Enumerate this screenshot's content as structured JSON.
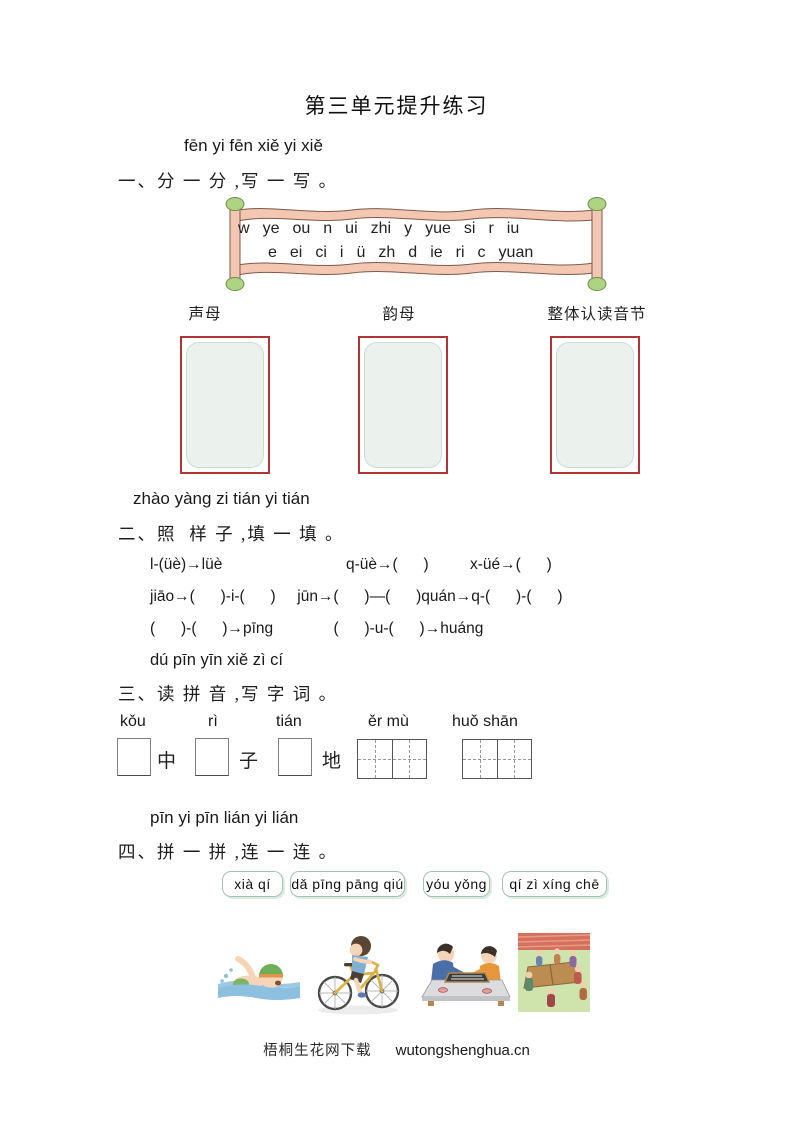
{
  "page": {
    "title": "第三单元提升练习",
    "footer": {
      "site_name": "梧桐生花网下载",
      "site_url": "wutongshenghua.cn"
    }
  },
  "section1": {
    "pinyin_intro": "fēn yi fēn xiě yi xiě",
    "heading": "一、分 一 分 ,写 一 写 。",
    "scroll": {
      "row1": [
        "w",
        "ye",
        "ou",
        "n",
        "ui",
        "zhi",
        "y",
        "yue",
        "si",
        "r",
        "iu"
      ],
      "row2": [
        "e",
        "ei",
        "ci",
        "i",
        "ü",
        "zh",
        "d",
        "ie",
        "ri",
        "c",
        "yuan"
      ]
    },
    "categories": [
      "声母",
      "韵母",
      "整体认读音节"
    ]
  },
  "section2": {
    "pinyin_intro": "zhào yàng zi tián yi tián",
    "heading": "二、照  样 子 ,填 一 填 。",
    "row1": [
      "l-(üè)→lüè",
      "q-üè→(      )",
      "x-üé→(      )"
    ],
    "row2": "jiāo→(      )-i-(      )     jūn→(      )—(      )quán→q-(      )-(      )",
    "row3": "(      )-(      )→pīng              (      )-u-(      )→huáng"
  },
  "section3": {
    "pinyin_intro": "dú pīn yīn xiě zì cí",
    "heading": "三、读 拼 音 ,写 字 词 。",
    "items": [
      {
        "pinyin": "kǒu",
        "character": "中",
        "box": "single"
      },
      {
        "pinyin": "rì",
        "character": "子",
        "box": "single"
      },
      {
        "pinyin": "tián",
        "character": "地",
        "box": "single"
      },
      {
        "pinyin": "ěr mù",
        "box": "double-grid"
      },
      {
        "pinyin": "huǒ shān",
        "box": "double-grid"
      }
    ]
  },
  "section4": {
    "pinyin_intro": "pīn yi pīn lián yi lián",
    "heading": "四、拼 一 拼 ,连 一 连 。",
    "tags": [
      "xià qí",
      "dǎ pīng pāng qiú",
      "yóu yǒng",
      "qí zì xíng chē"
    ],
    "images": [
      "swimming",
      "riding-bicycle",
      "playing-board-game",
      "playing-table-tennis"
    ]
  },
  "colors": {
    "sort_box_border": "#b03636",
    "sort_box_fill": "#ebf2ee",
    "scroll_band": "#f4c7b2",
    "scroll_cap": "#aed383",
    "tag_border": "#a5c3b5"
  }
}
